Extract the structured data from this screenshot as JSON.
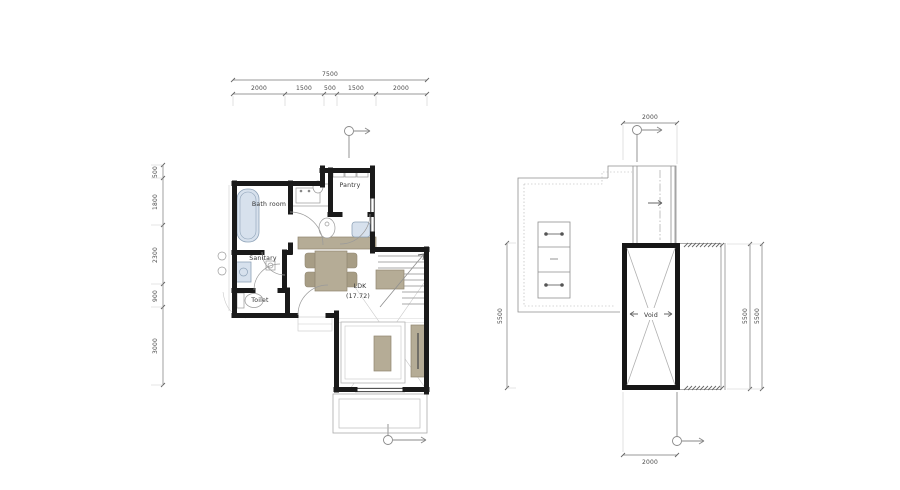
{
  "first_floor": {
    "rooms": {
      "bath": "Bath room",
      "pantry": "Pantry",
      "sanitary": "Sanitary",
      "toilet": "Toilet",
      "ldk": "LDK",
      "ldk_area": "(17.72)"
    },
    "dims": {
      "total_width": "7500",
      "top": [
        "2000",
        "1500",
        "500",
        "1500",
        "2000"
      ],
      "left": [
        "500",
        "1800",
        "2300",
        "900",
        "3000"
      ]
    }
  },
  "second_floor": {
    "rooms": {
      "void": "Void"
    },
    "dims": {
      "top": "2000",
      "bottom": "2000",
      "left": "5500",
      "right_inner": "5500",
      "right_outer": "5500"
    }
  },
  "colors": {
    "wall": "#1a1a1a",
    "furniture_beige": "#b5ac96",
    "furniture_beige_dark": "#a79d85",
    "fixture_blue": "#d7e1ed",
    "line_gray": "#8f8f8f",
    "dim_text": "#4a4a4a"
  }
}
